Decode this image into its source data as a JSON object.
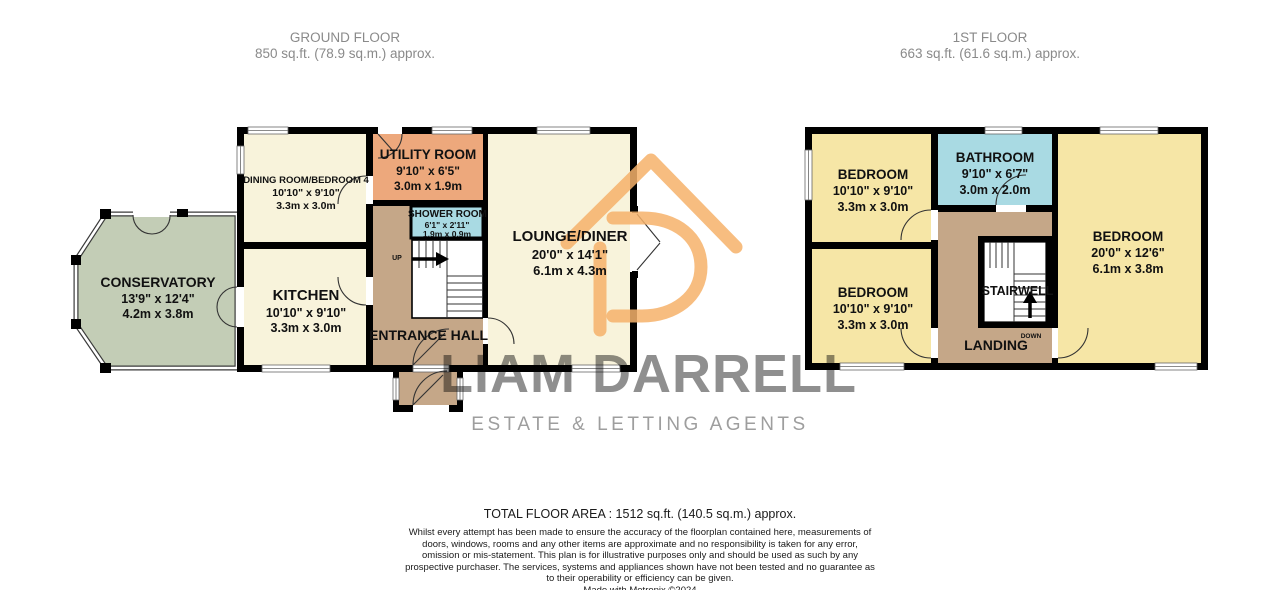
{
  "ground_floor": {
    "title": "GROUND FLOOR",
    "area": "850 sq.ft. (78.9 sq.m.) approx.",
    "stair_direction": "UP",
    "rooms": {
      "dining_room": {
        "name": "DINING ROOM/BEDROOM 4",
        "imperial": "10'10\" x 9'10\"",
        "metric": "3.3m x 3.0m"
      },
      "utility_room": {
        "name": "UTILITY ROOM",
        "imperial": "9'10\" x 6'5\"",
        "metric": "3.0m x 1.9m"
      },
      "shower_room": {
        "name": "SHOWER ROOM",
        "imperial": "6'1\" x 2'11\"",
        "metric": "1.9m x 0.9m"
      },
      "kitchen": {
        "name": "KITCHEN",
        "imperial": "10'10\" x 9'10\"",
        "metric": "3.3m x 3.0m"
      },
      "lounge_diner": {
        "name": "LOUNGE/DINER",
        "imperial": "20'0\" x 14'1\"",
        "metric": "6.1m x 4.3m"
      },
      "conservatory": {
        "name": "CONSERVATORY",
        "imperial": "13'9\" x 12'4\"",
        "metric": "4.2m x 3.8m"
      },
      "entrance_hall": {
        "name": "ENTRANCE HALL"
      }
    }
  },
  "first_floor": {
    "title": "1ST FLOOR",
    "area": "663 sq.ft. (61.6 sq.m.) approx.",
    "stair_direction": "DOWN",
    "rooms": {
      "bedroom_top_left": {
        "name": "BEDROOM",
        "imperial": "10'10\" x 9'10\"",
        "metric": "3.3m x 3.0m"
      },
      "bedroom_bottom_left": {
        "name": "BEDROOM",
        "imperial": "10'10\" x 9'10\"",
        "metric": "3.3m x 3.0m"
      },
      "bedroom_right": {
        "name": "BEDROOM",
        "imperial": "20'0\" x 12'6\"",
        "metric": "6.1m x 3.8m"
      },
      "bathroom": {
        "name": "BATHROOM",
        "imperial": "9'10\" x 6'7\"",
        "metric": "3.0m x 2.0m"
      },
      "stairwell": {
        "name": "STAIRWELL"
      },
      "landing": {
        "name": "LANDING"
      }
    }
  },
  "watermark": {
    "brand": "LIAM DARRELL",
    "tagline": "ESTATE & LETTING AGENTS",
    "logo": "house-with-d-logo"
  },
  "footer": {
    "total_area": "TOTAL FLOOR AREA : 1512 sq.ft. (140.5 sq.m.) approx.",
    "disclaimer": "Whilst every attempt has been made to ensure the accuracy of the floorplan contained here, measurements of doors, windows, rooms and any other items are approximate and no responsibility is taken for any error, omission or mis-statement. This plan is for illustrative purposes only and should be used as such by any prospective purchaser. The services, systems and appliances shown have not been tested and no guarantee as to their operability or efficiency can be given.",
    "credit": "Made with Metropix ©2024"
  },
  "colors": {
    "wall": "#000000",
    "room_cream": "#F8F3DB",
    "room_yellow": "#F6E6A6",
    "utility_orange": "#EDA87C",
    "wet_room_blue": "#A9DAE3",
    "hall_tan": "#C5A788",
    "conservatory_green": "#C3CDB6",
    "logo_orange": "#F6B26B",
    "watermark_gray": "#8F8F8F"
  }
}
